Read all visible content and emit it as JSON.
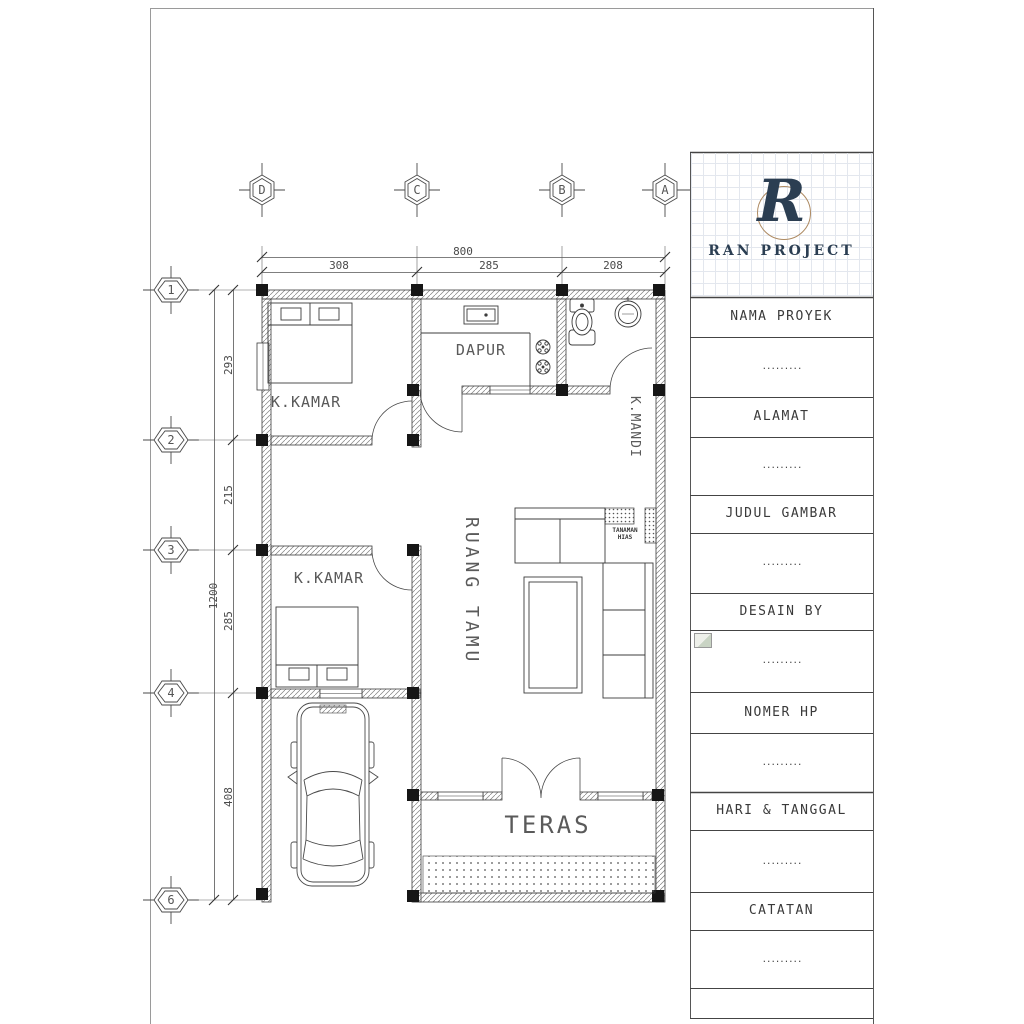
{
  "logo": {
    "monogram": "R",
    "brand": "RAN PROJECT"
  },
  "title_block": {
    "rows": [
      {
        "label": "NAMA PROYEK",
        "value": "........."
      },
      {
        "label": "ALAMAT",
        "value": "........."
      },
      {
        "label": "JUDUL GAMBAR",
        "value": "........."
      },
      {
        "label": "DESAIN BY",
        "value": "........."
      },
      {
        "label": "NOMER HP",
        "value": "........."
      },
      {
        "label": "HARI & TANGGAL",
        "value": "........."
      },
      {
        "label": "CATATAN",
        "value": "........."
      }
    ]
  },
  "plan": {
    "room_labels": {
      "bedroom_top": "K.KAMAR",
      "kitchen": "DAPUR",
      "bathroom": "K.MANDI",
      "bedroom_bottom": "K.KAMAR",
      "living_room": "RUANG TAMU",
      "terrace": "TERAS",
      "plant": "TANAMAN HIAS"
    },
    "grid_columns": [
      "D",
      "C",
      "B",
      "A"
    ],
    "grid_rows": [
      "1",
      "2",
      "3",
      "4",
      "6"
    ],
    "dimensions": {
      "top_total": "800",
      "top_segments": [
        "308",
        "285",
        "208"
      ],
      "left_total": "1200",
      "left_segments": [
        "293",
        "215",
        "285",
        "408"
      ]
    }
  },
  "colors": {
    "ink": "#3c3c3c",
    "navy": "#2b3e52",
    "tan": "#ad8a62"
  }
}
